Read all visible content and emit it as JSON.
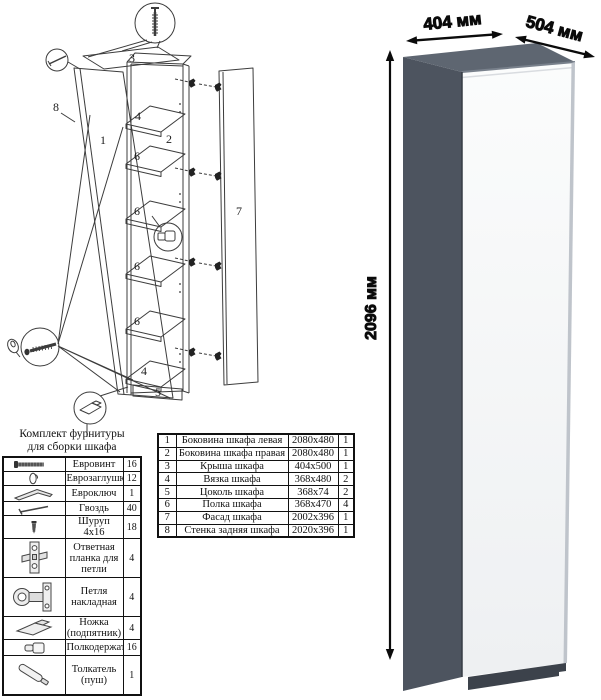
{
  "hardware_kit": {
    "title_line1": "Комплект фурнитуры",
    "title_line2": "для сборки шкафа",
    "rows": [
      {
        "icon": "euro-screw-icon",
        "name": "Евровинт",
        "qty": "16"
      },
      {
        "icon": "euro-cap-icon",
        "name": "Еврозаглушка",
        "qty": "12"
      },
      {
        "icon": "hex-key-icon",
        "name": "Евроключ",
        "qty": "1"
      },
      {
        "icon": "nail-icon",
        "name": "Гвоздь",
        "qty": "40"
      },
      {
        "icon": "screw-icon",
        "name": "Шуруп 4x16",
        "qty": "18"
      },
      {
        "icon": "striker-plate-icon",
        "name": "Ответная планка для петли",
        "qty": "4"
      },
      {
        "icon": "hinge-icon",
        "name": "Петля накладная",
        "qty": "4"
      },
      {
        "icon": "foot-icon",
        "name": "Ножка (подпятник)",
        "qty": "4"
      },
      {
        "icon": "shelf-support-icon",
        "name": "Полкодержатель",
        "qty": "16"
      },
      {
        "icon": "push-latch-icon",
        "name": "Толкатель (пуш)",
        "qty": "1"
      }
    ]
  },
  "parts_table": {
    "rows": [
      {
        "num": "1",
        "name": "Боковина шкафа левая",
        "size": "2080x480",
        "qty": "1"
      },
      {
        "num": "2",
        "name": "Боковина шкафа правая",
        "size": "2080x480",
        "qty": "1"
      },
      {
        "num": "3",
        "name": "Крыша шкафа",
        "size": "404x500",
        "qty": "1"
      },
      {
        "num": "4",
        "name": "Вязка шкафа",
        "size": "368x480",
        "qty": "2"
      },
      {
        "num": "5",
        "name": "Цоколь шкафа",
        "size": "368x74",
        "qty": "2"
      },
      {
        "num": "6",
        "name": "Полка шкафа",
        "size": "368x470",
        "qty": "4"
      },
      {
        "num": "7",
        "name": "Фасад шкафа",
        "size": "2002x396",
        "qty": "1"
      },
      {
        "num": "8",
        "name": "Стенка задняя шкафа",
        "size": "2020x396",
        "qty": "1"
      }
    ]
  },
  "dimensions": {
    "width": "404 мм",
    "depth": "504 мм",
    "height": "2096 мм"
  },
  "diagram_labels": {
    "p1": "1",
    "p2": "2",
    "p3": "3",
    "p4_top": "4",
    "p4_bottom": "4",
    "p5": "5",
    "p6_1": "6",
    "p6_2": "6",
    "p6_3": "6",
    "p6_4": "6",
    "p7": "7",
    "p8": "8"
  },
  "colors": {
    "side": "#4d545f",
    "top": "#5e6671",
    "plinth": "#3c424b",
    "door": "#f9fafb"
  }
}
